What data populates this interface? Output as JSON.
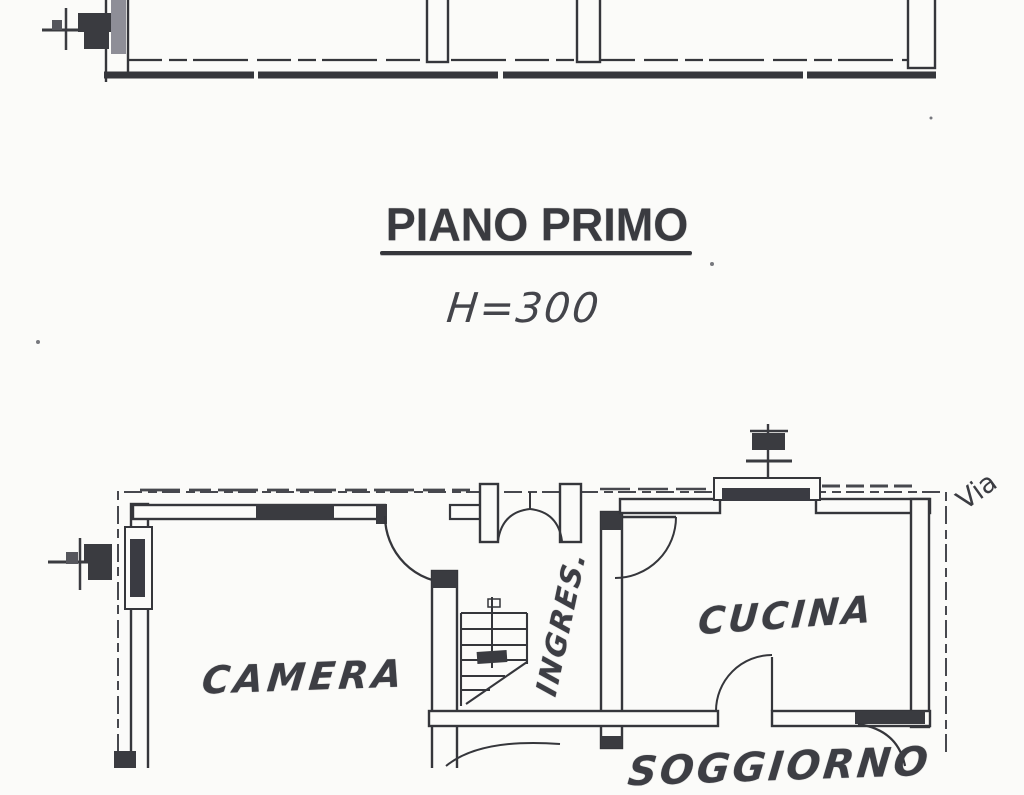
{
  "page": {
    "kind": "scanned architectural floor plan",
    "paper_color": "#fbfbf9",
    "ink_color": "#35363b"
  },
  "title_block": {
    "title": "PIANO PRIMO",
    "height_label": "H=300"
  },
  "rooms": {
    "camera": "CAMERA",
    "ingresso": "INGRES.",
    "cucina": "CUCINA",
    "soggiorno": "SOGGIORNO"
  },
  "annotations": {
    "street": "Via"
  },
  "symbols": [
    "chimney-flue-symbol-upper-left",
    "chimney-flue-symbol-lower-left",
    "chimney-flue-symbol-above-kitchen"
  ]
}
